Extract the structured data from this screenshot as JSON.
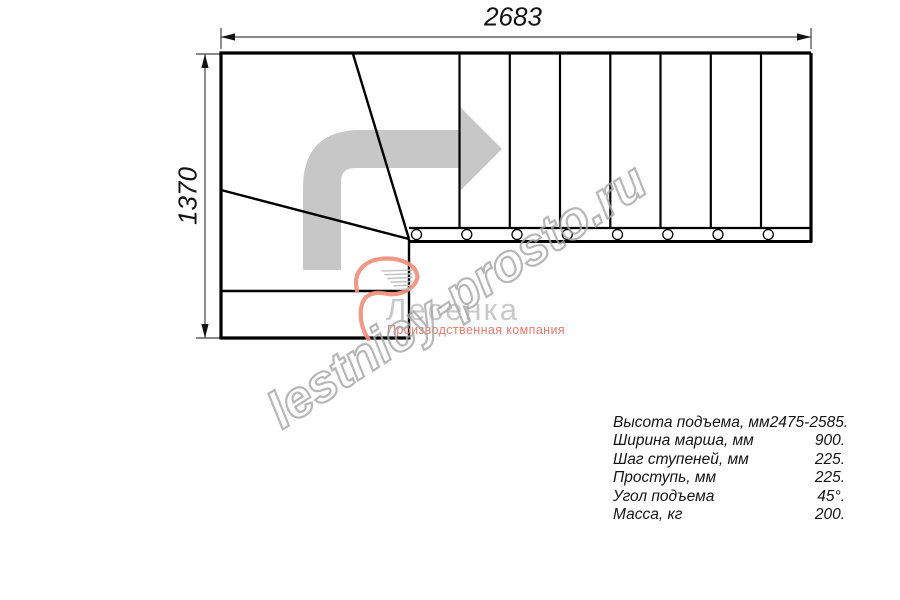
{
  "page": {
    "background": "#ffffff"
  },
  "dimensions": {
    "width_mm": "2683",
    "height_mm": "1370"
  },
  "watermark": {
    "text": "lestnicy-prosto.ru",
    "color": "#a6a6a6"
  },
  "logo": {
    "name": "Лесенка",
    "tagline": "Производственная компания",
    "name_color": "#c7c7c7",
    "tagline_color": "#e87a6e",
    "swoosh_color": "#f0907c",
    "swoosh_icon": "logo-swoosh-icon"
  },
  "drawing": {
    "type": "stair-plan-top-view",
    "line_color": "#000000",
    "arrow_color": "#c7c7c7",
    "arrow_icon": "direction-arrow-icon",
    "straight_treads": 8,
    "baluster_circles": 8,
    "winder_steps": 3
  },
  "specs": {
    "rows": [
      {
        "label": "Высота подъема, мм",
        "value": "2475-2585."
      },
      {
        "label": "Ширина марша, мм",
        "value": "900."
      },
      {
        "label": "Шаг ступеней, мм",
        "value": "225."
      },
      {
        "label": "Проступь, мм",
        "value": "225."
      },
      {
        "label": "Угол подъема",
        "value": "45°."
      },
      {
        "label": "Масса, кг",
        "value": "200."
      }
    ]
  }
}
